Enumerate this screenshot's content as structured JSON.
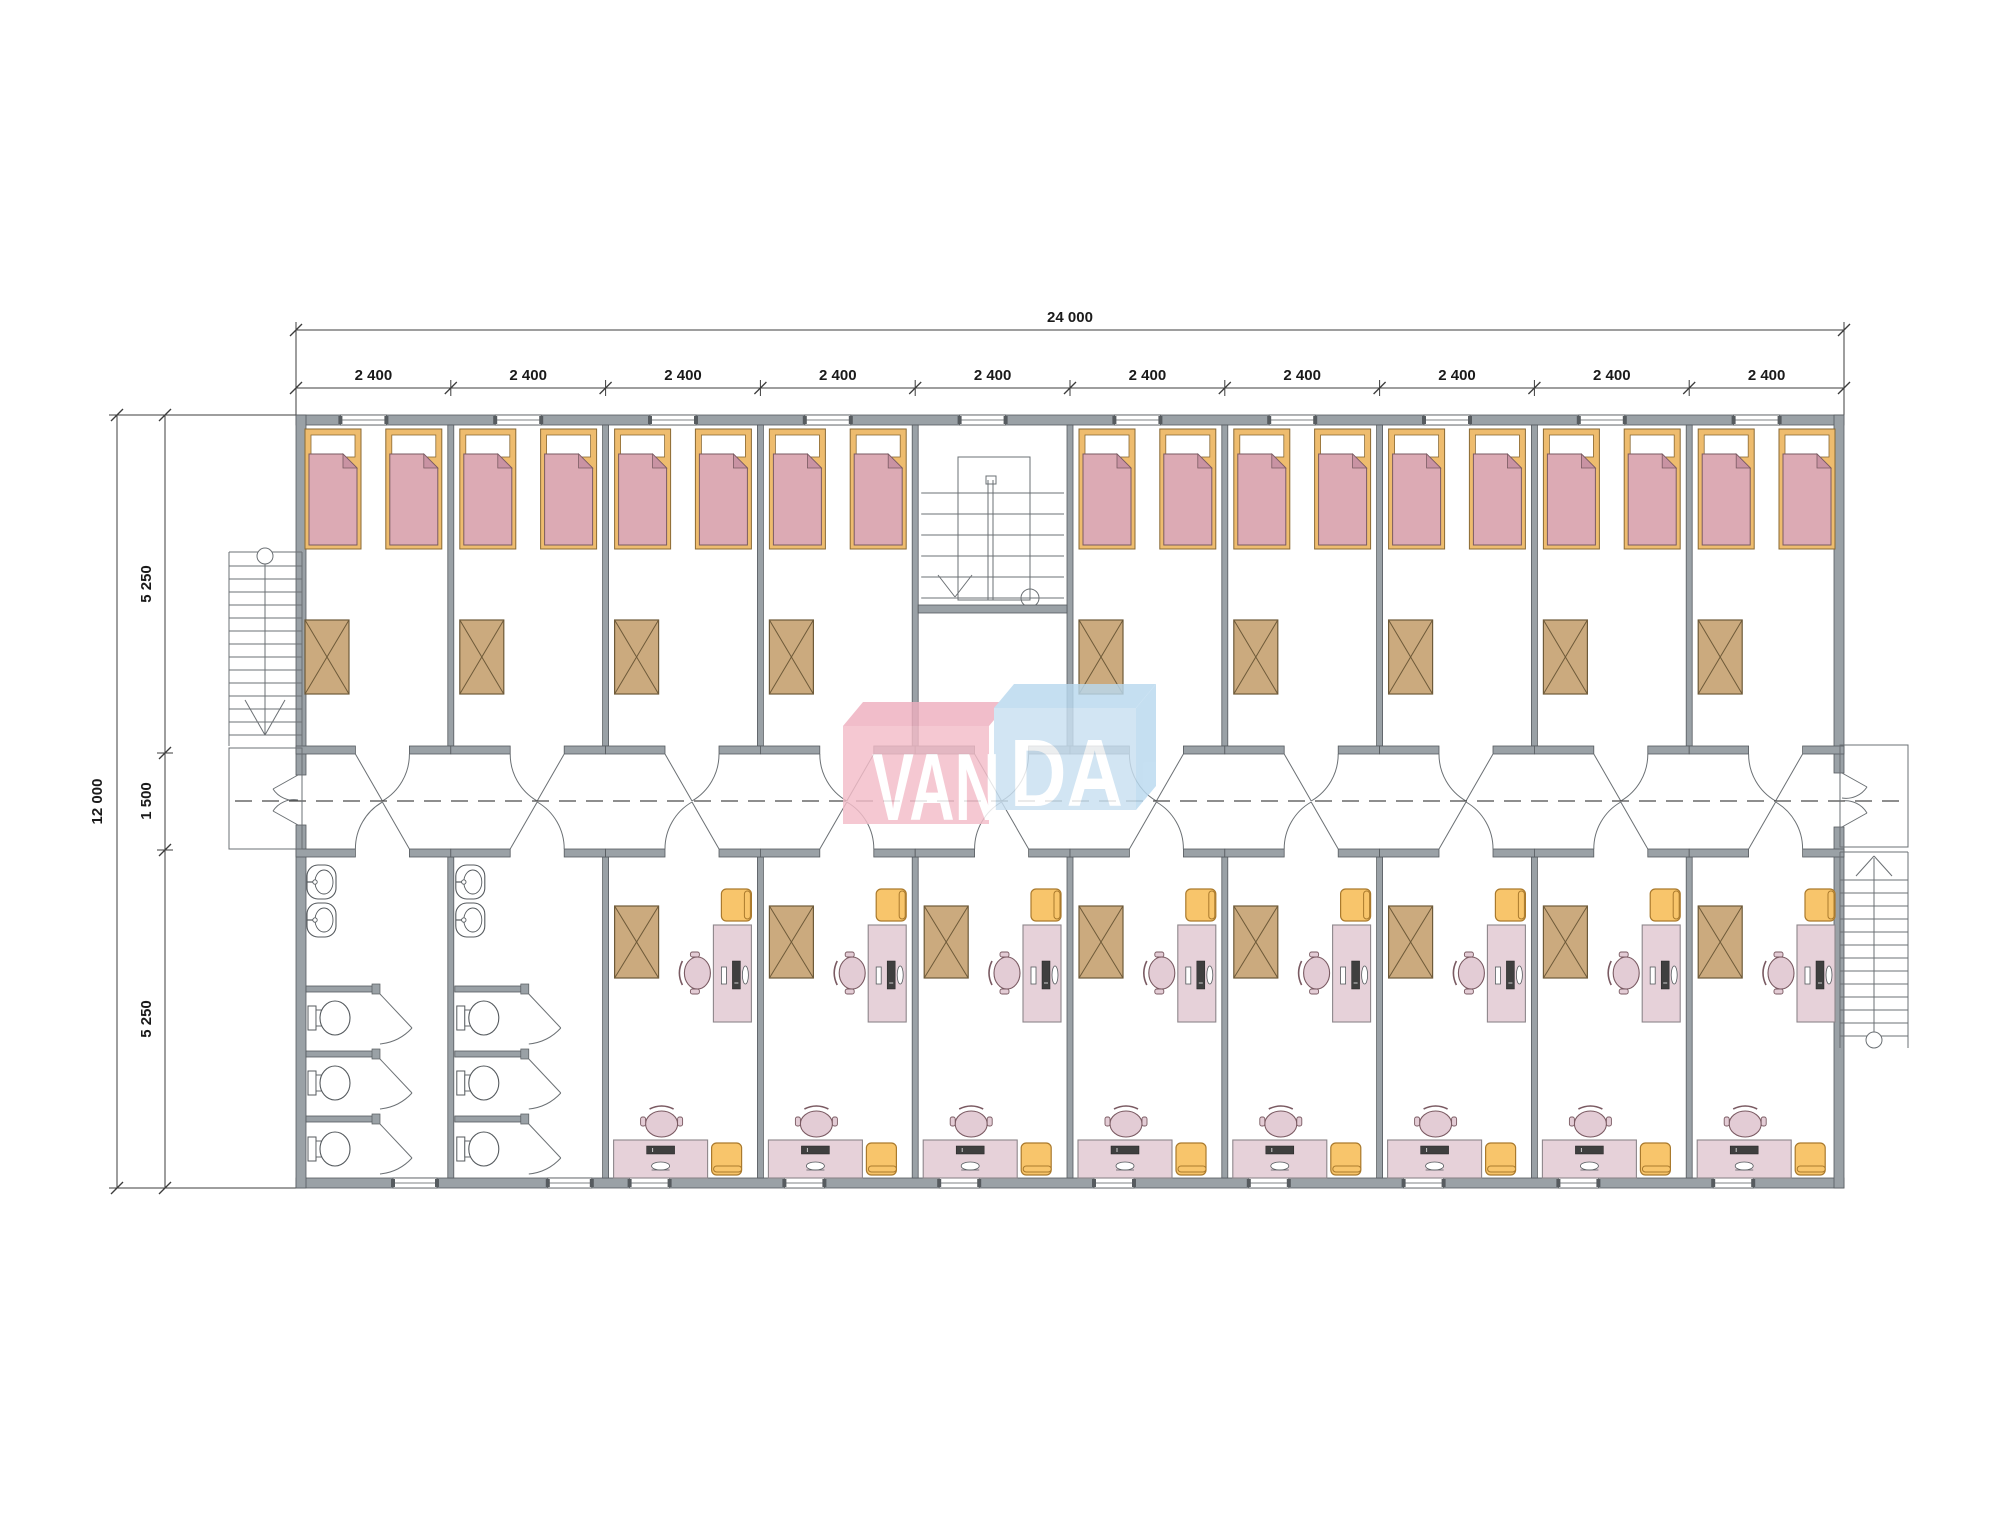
{
  "dimensions": {
    "top_total": "24 000",
    "top_segments": [
      "2 400",
      "2 400",
      "2 400",
      "2 400",
      "2 400",
      "2 400",
      "2 400",
      "2 400",
      "2 400",
      "2 400"
    ],
    "left_total": "12 000",
    "left_segments": [
      "5 250",
      "1 500",
      "5 250"
    ]
  },
  "logo": {
    "left_text": "VAN",
    "right_text": "DA",
    "left_color": "#f4bdc9",
    "left_top_color": "#eeafbf",
    "right_color": "#c9e0f1",
    "right_top_color": "#b9d9ef",
    "text_color": "#ffffff"
  },
  "palette": {
    "background": "#ffffff",
    "wall_fill": "#9aa1a6",
    "wall_stroke": "#565b5f",
    "line": "#3c3c3c",
    "thin_line": "#6b7074",
    "fixture_stroke": "#555a5e",
    "bed_frame": "#eebc6e",
    "bed_frame_stroke": "#8a6a34",
    "blanket": "#dcaab4",
    "blanket_fold": "#c993a3",
    "blanket_stroke": "#7a5a62",
    "wardrobe": "#cbaa7e",
    "wardrobe_stroke": "#6e5a39",
    "desk": "#e6d1d9",
    "desk_stroke": "#8d868a",
    "chair": "#e3ccd5",
    "stool": "#f8c56b",
    "stool_stroke": "#aa7a2d",
    "monitor": "#3f3f3f",
    "dim_text": "#1a1a1a"
  },
  "building": {
    "modules": 10,
    "stair_hall_module": 5,
    "bathroom_modules": [
      1,
      2
    ],
    "bedroom_count": 9,
    "beds_per_bedroom": 2,
    "wardrobes_top_row": 9,
    "study_room_count": 8,
    "toilets_per_bathroom": 3,
    "sinks_per_bathroom": 2,
    "external_stairs": 2,
    "central_stairwell": 1
  }
}
